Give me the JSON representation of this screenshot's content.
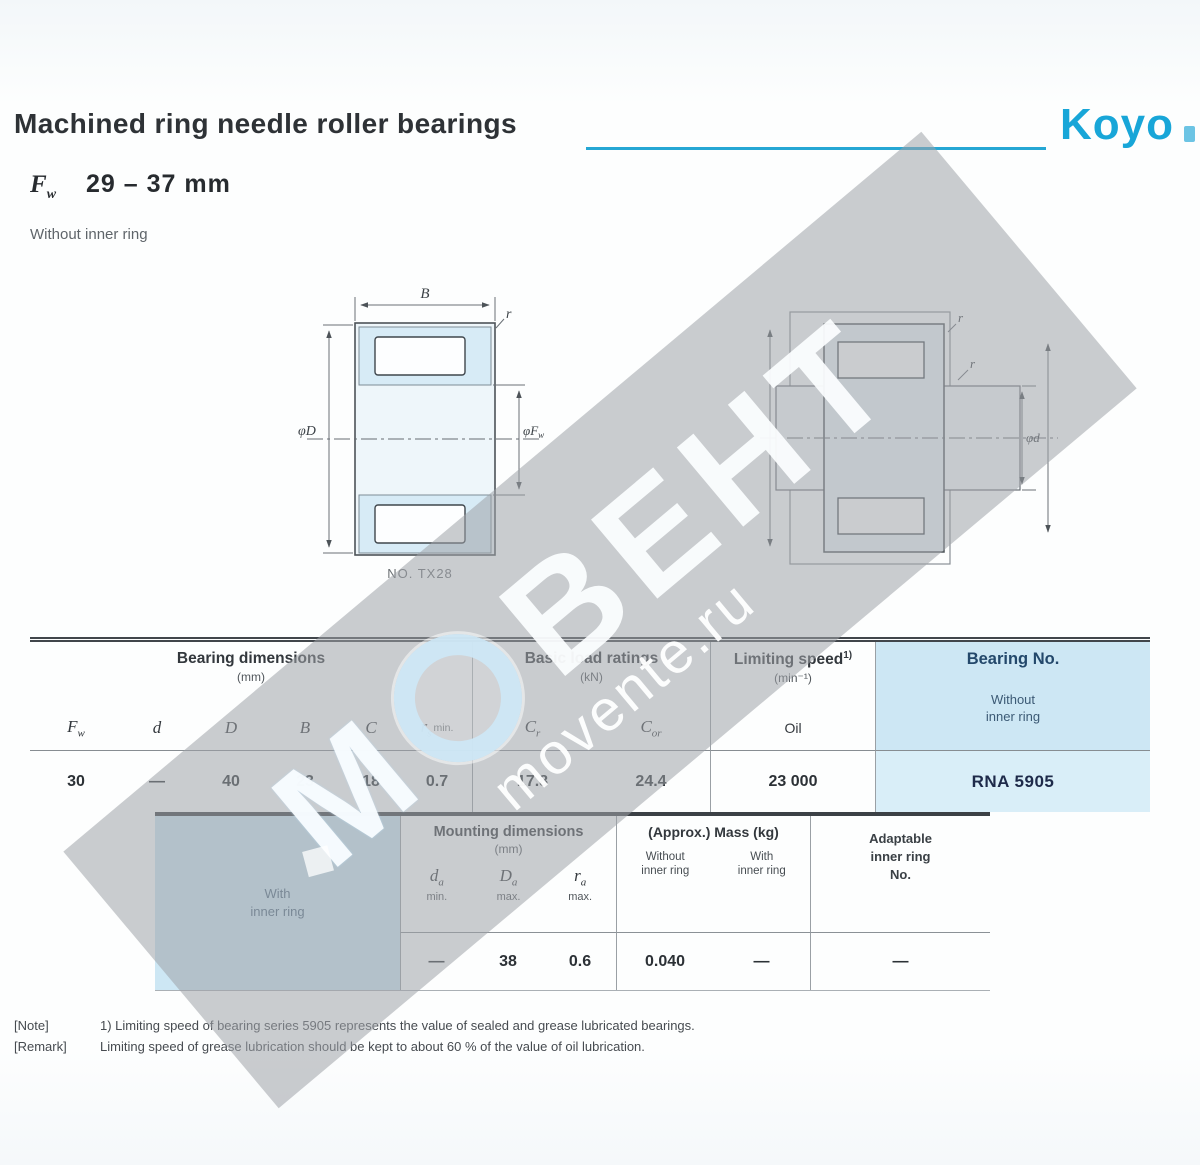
{
  "header": {
    "title": "Machined ring needle roller bearings",
    "brand": "Koyo",
    "dim_symbol_main": "F",
    "dim_symbol_sub": "w",
    "dim_range": "29 – 37 mm",
    "subtitle": "Without inner ring"
  },
  "figures": {
    "fig1": {
      "label_b": "B",
      "label_r": "r",
      "label_od": "φD",
      "label_fw_main": "φF",
      "label_fw_sub": "w",
      "caption": "NO. TX28"
    },
    "fig2": {
      "label_r1": "r",
      "label_r2": "r",
      "label_d": "φd",
      "label_fw_main": "φF",
      "label_fw_sub": "w"
    }
  },
  "table1": {
    "group_dims": "Bearing dimensions",
    "group_dims_unit": "(mm)",
    "group_load": "Basic load ratings",
    "group_load_unit": "(kN)",
    "group_speed": "Limiting speed",
    "group_speed_sup": "1)",
    "group_speed_unit": "(min⁻¹)",
    "group_bearing": "Bearing No.",
    "bearing_sub1": "Without",
    "bearing_sub2": "inner ring",
    "sym_fw_main": "F",
    "sym_fw_sub": "w",
    "sym_d": "d",
    "sym_D": "D",
    "sym_B": "B",
    "sym_C": "C",
    "sym_r_main": "r",
    "sym_r_sub": "s",
    "sym_r_tail": "min.",
    "sym_cr_main": "C",
    "sym_cr_sub": "r",
    "sym_cor_main": "C",
    "sym_cor_sub": "or",
    "sym_oil": "Oil",
    "row": {
      "fw": "30",
      "d": "—",
      "D": "40",
      "B": "23",
      "C": "18",
      "r": "0.7",
      "cr": "17.8",
      "cor": "24.4",
      "speed": "23 000",
      "bearing_no": "RNA 5905"
    }
  },
  "table2": {
    "left_line1": "With",
    "left_line2": "inner ring",
    "group_mount": "Mounting dimensions",
    "group_mount_unit": "(mm)",
    "sym_da_main": "d",
    "sym_da_sub": "a",
    "sym_da_limit": "min.",
    "sym_Da_main": "D",
    "sym_Da_sub": "a",
    "sym_Da_limit": "max.",
    "sym_ra_main": "r",
    "sym_ra_sub": "a",
    "sym_ra_limit": "max.",
    "group_mass": "(Approx.) Mass (kg)",
    "mass_sub1_line1": "Without",
    "mass_sub1_line2": "inner ring",
    "mass_sub2_line1": "With",
    "mass_sub2_line2": "inner ring",
    "adapt_line1": "Adaptable",
    "adapt_line2": "inner ring",
    "adapt_line3": "No.",
    "row": {
      "da": "—",
      "Da": "38",
      "ra": "0.6",
      "mass_without": "0.040",
      "mass_with": "—",
      "adapt": "—"
    }
  },
  "notes": {
    "note_label": "[Note]",
    "note_text": "1) Limiting speed of bearing series 5905 represents the value of sealed and grease lubricated bearings.",
    "remark_label": "[Remark]",
    "remark_text": "Limiting speed of grease lubrication should be kept to about 60 % of the value of oil lubrication."
  },
  "watermark": {
    "letter": "М",
    "word": "ВЕНТ",
    "site": "movente.ru"
  }
}
